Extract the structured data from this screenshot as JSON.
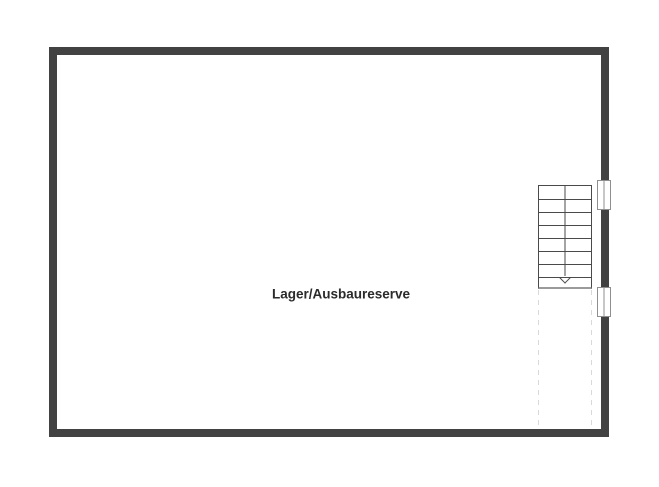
{
  "floorplan": {
    "room": {
      "label": "Lager/Ausbaureserve"
    },
    "stairs": {
      "steps": 8,
      "direction": "down"
    },
    "windows": [
      {
        "id": "window-upper-right"
      },
      {
        "id": "window-lower-right"
      }
    ],
    "colors": {
      "background": "#ffffff",
      "wall": "#424242",
      "stair_line": "#4a4a4a",
      "stair_cut_line": "#9a9a9a",
      "dashed_line": "#d9d9d9",
      "window_border": "#8f8f8f",
      "label": "#2b2b2b"
    }
  }
}
